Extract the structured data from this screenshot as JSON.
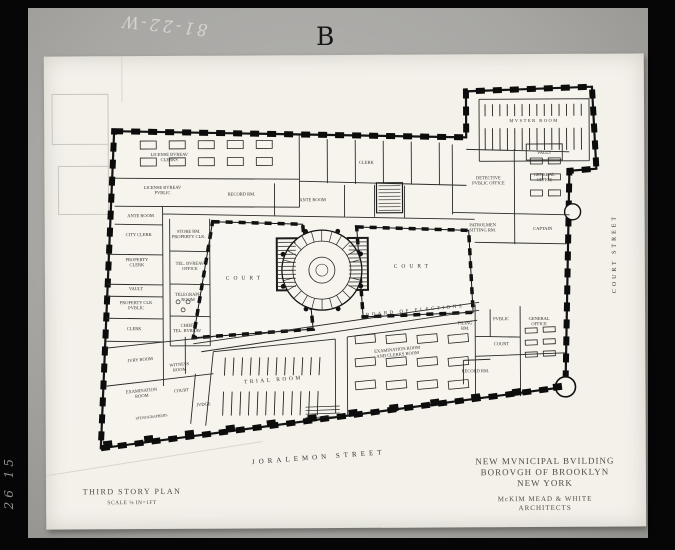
{
  "colors": {
    "paper": "#f3f1ea",
    "ink": "#1a1a1a",
    "photo_bg": "#a8a7a4",
    "frame": "#060606"
  },
  "photo": {
    "plate_letter": "B",
    "negative_number": "81-22-W",
    "margin_number": "26 15"
  },
  "titleblock": {
    "building": "NEW MVNICIPAL BVILDING",
    "borough": "BOROVGH OF BROOKLYN",
    "city": "NEW YORK",
    "architects": "McKIM MEAD & WHITE ARCHITECTS",
    "plan_title": "THIRD STORY PLAN",
    "scale": "SCALE ⅛ IN=1FT"
  },
  "plan": {
    "streets": [
      "JORALEMON STREET",
      "COURT STREET"
    ],
    "labels": [
      {
        "n": "room-label",
        "l": [
          "LICENSE BVREAV",
          "CLERKS"
        ],
        "x": 125,
        "y": 100
      },
      {
        "n": "room-label",
        "l": [
          "LICENSE BVREAV",
          "PVBLIC"
        ],
        "x": 118,
        "y": 133
      },
      {
        "n": "room-label",
        "t": "ANTE ROOM",
        "x": 96,
        "y": 161
      },
      {
        "n": "room-label",
        "t": "RECORD RM.",
        "x": 197,
        "y": 140
      },
      {
        "n": "room-label",
        "t": "ANTE ROOM",
        "x": 268,
        "y": 146
      },
      {
        "n": "room-label",
        "t": "CLERK",
        "x": 322,
        "y": 109
      },
      {
        "n": "room-label",
        "t": "CITY CLERK",
        "x": 94,
        "y": 180
      },
      {
        "n": "room-label",
        "l": [
          "PROPERTY",
          "CLERK"
        ],
        "x": 92,
        "y": 205
      },
      {
        "n": "room-label",
        "t": "VAULT",
        "x": 91,
        "y": 234
      },
      {
        "n": "room-label",
        "l": [
          "PROPERTY CLK",
          "PVBLIC"
        ],
        "x": 91,
        "y": 248
      },
      {
        "n": "room-label",
        "t": "CLERK",
        "x": 89,
        "y": 274
      },
      {
        "n": "room-label",
        "l": [
          "STORE RM.",
          "PROPERTY CLK."
        ],
        "x": 144,
        "y": 177
      },
      {
        "n": "room-label",
        "l": [
          "TEL. BVREAV",
          "OFFICE"
        ],
        "x": 145,
        "y": 209
      },
      {
        "n": "room-label",
        "l": [
          "TELEGRAPH",
          "ROOM"
        ],
        "x": 143,
        "y": 240
      },
      {
        "n": "room-label",
        "l": [
          "CHIEF",
          "TEL. BVREAV"
        ],
        "x": 142,
        "y": 271
      },
      {
        "n": "court-label",
        "t": "COURT",
        "x": 200,
        "y": 224,
        "fs": 5.5,
        "ls": 4
      },
      {
        "n": "court-label",
        "t": "COURT",
        "x": 368,
        "y": 213,
        "fs": 5.5,
        "ls": 4
      },
      {
        "n": "room-label",
        "t": "MVSTER ROOM",
        "x": 490,
        "y": 68,
        "ls": 1.5
      },
      {
        "n": "room-label",
        "t": "VAULT",
        "x": 500,
        "y": 100
      },
      {
        "n": "room-label",
        "l": [
          "DETECTIVE",
          "PVBLIC OFFICE"
        ],
        "x": 444,
        "y": 125
      },
      {
        "n": "room-label",
        "l": [
          "GENERAL",
          "OFFICE"
        ],
        "x": 500,
        "y": 122
      },
      {
        "n": "room-label",
        "l": [
          "PATROLMEN",
          "SITTING RM."
        ],
        "x": 438,
        "y": 172
      },
      {
        "n": "room-label",
        "t": "CAPTAIN",
        "x": 498,
        "y": 176
      },
      {
        "n": "corridor-label",
        "t": "BOARD OF ELECTIONS",
        "x": 370,
        "y": 257,
        "fs": 5,
        "ls": 2.5,
        "r": -5
      },
      {
        "n": "room-label",
        "l": [
          "FILING",
          "RM."
        ],
        "x": 420,
        "y": 270
      },
      {
        "n": "room-label",
        "t": "PVBLIC",
        "x": 456,
        "y": 266
      },
      {
        "n": "room-label",
        "t": "COURT",
        "x": 456,
        "y": 291
      },
      {
        "n": "room-label",
        "l": [
          "GENERAL",
          "OFFICE"
        ],
        "x": 494,
        "y": 266
      },
      {
        "n": "room-label",
        "t": "RECORD RM.",
        "x": 430,
        "y": 318
      },
      {
        "n": "room-label",
        "t": "TRIAL ROOM",
        "x": 228,
        "y": 326,
        "fs": 5.5,
        "ls": 2.5,
        "r": -4
      },
      {
        "n": "room-label",
        "l": [
          "EXAMINATION ROOM",
          "AND CLERKS ROOM"
        ],
        "x": 352,
        "y": 296,
        "r": -5
      },
      {
        "n": "room-label",
        "t": "JVRY ROOM",
        "x": 95,
        "y": 305,
        "r": -5
      },
      {
        "n": "room-label",
        "l": [
          "WITNESS",
          "ROOM"
        ],
        "x": 134,
        "y": 310,
        "r": -5
      },
      {
        "n": "room-label",
        "l": [
          "EXAMINATION",
          "ROOM"
        ],
        "x": 96,
        "y": 336,
        "r": -5
      },
      {
        "n": "room-label",
        "t": "COURT",
        "x": 136,
        "y": 336,
        "r": -5
      },
      {
        "n": "room-label",
        "t": "JVDGE",
        "x": 158,
        "y": 350,
        "r": -5
      },
      {
        "n": "room-label",
        "t": "STENOGRAPHERS",
        "x": 106,
        "y": 362,
        "r": -6,
        "fs": 3.8
      },
      {
        "n": "street-label",
        "t": "JORALEMON STREET",
        "x": 273,
        "y": 404,
        "fs": 7,
        "ls": 4,
        "r": -4
      },
      {
        "n": "street-label",
        "t": "COURT STREET",
        "x": 571,
        "y": 200,
        "fs": 6,
        "ls": 3,
        "r": -90
      },
      {
        "n": "title-line",
        "t": "NEW MVNICIPAL BVILDING",
        "x": 499,
        "y": 410,
        "fs": 9,
        "c": "title",
        "ls": 1
      },
      {
        "n": "title-line",
        "t": "BOROVGH OF BROOKLYN",
        "x": 499,
        "y": 421,
        "fs": 9,
        "c": "title",
        "ls": 1
      },
      {
        "n": "title-line",
        "t": "NEW YORK",
        "x": 499,
        "y": 432,
        "fs": 9,
        "c": "title",
        "ls": 1
      },
      {
        "n": "architect-line",
        "t": "McKIM MEAD & WHITE",
        "x": 499,
        "y": 447,
        "fs": 7,
        "c": "title",
        "ls": 1
      },
      {
        "n": "architect-line",
        "t": "ARCHITECTS",
        "x": 499,
        "y": 456,
        "fs": 7,
        "c": "title",
        "ls": 1
      },
      {
        "n": "plan-title",
        "t": "THIRD STORY PLAN",
        "x": 86,
        "y": 438,
        "fs": 8,
        "c": "title",
        "ls": 1.5
      },
      {
        "n": "plan-scale",
        "t": "SCALE ⅛ IN=1FT",
        "x": 86,
        "y": 448,
        "fs": 5.5,
        "c": "title",
        "ls": 0.5
      }
    ]
  }
}
